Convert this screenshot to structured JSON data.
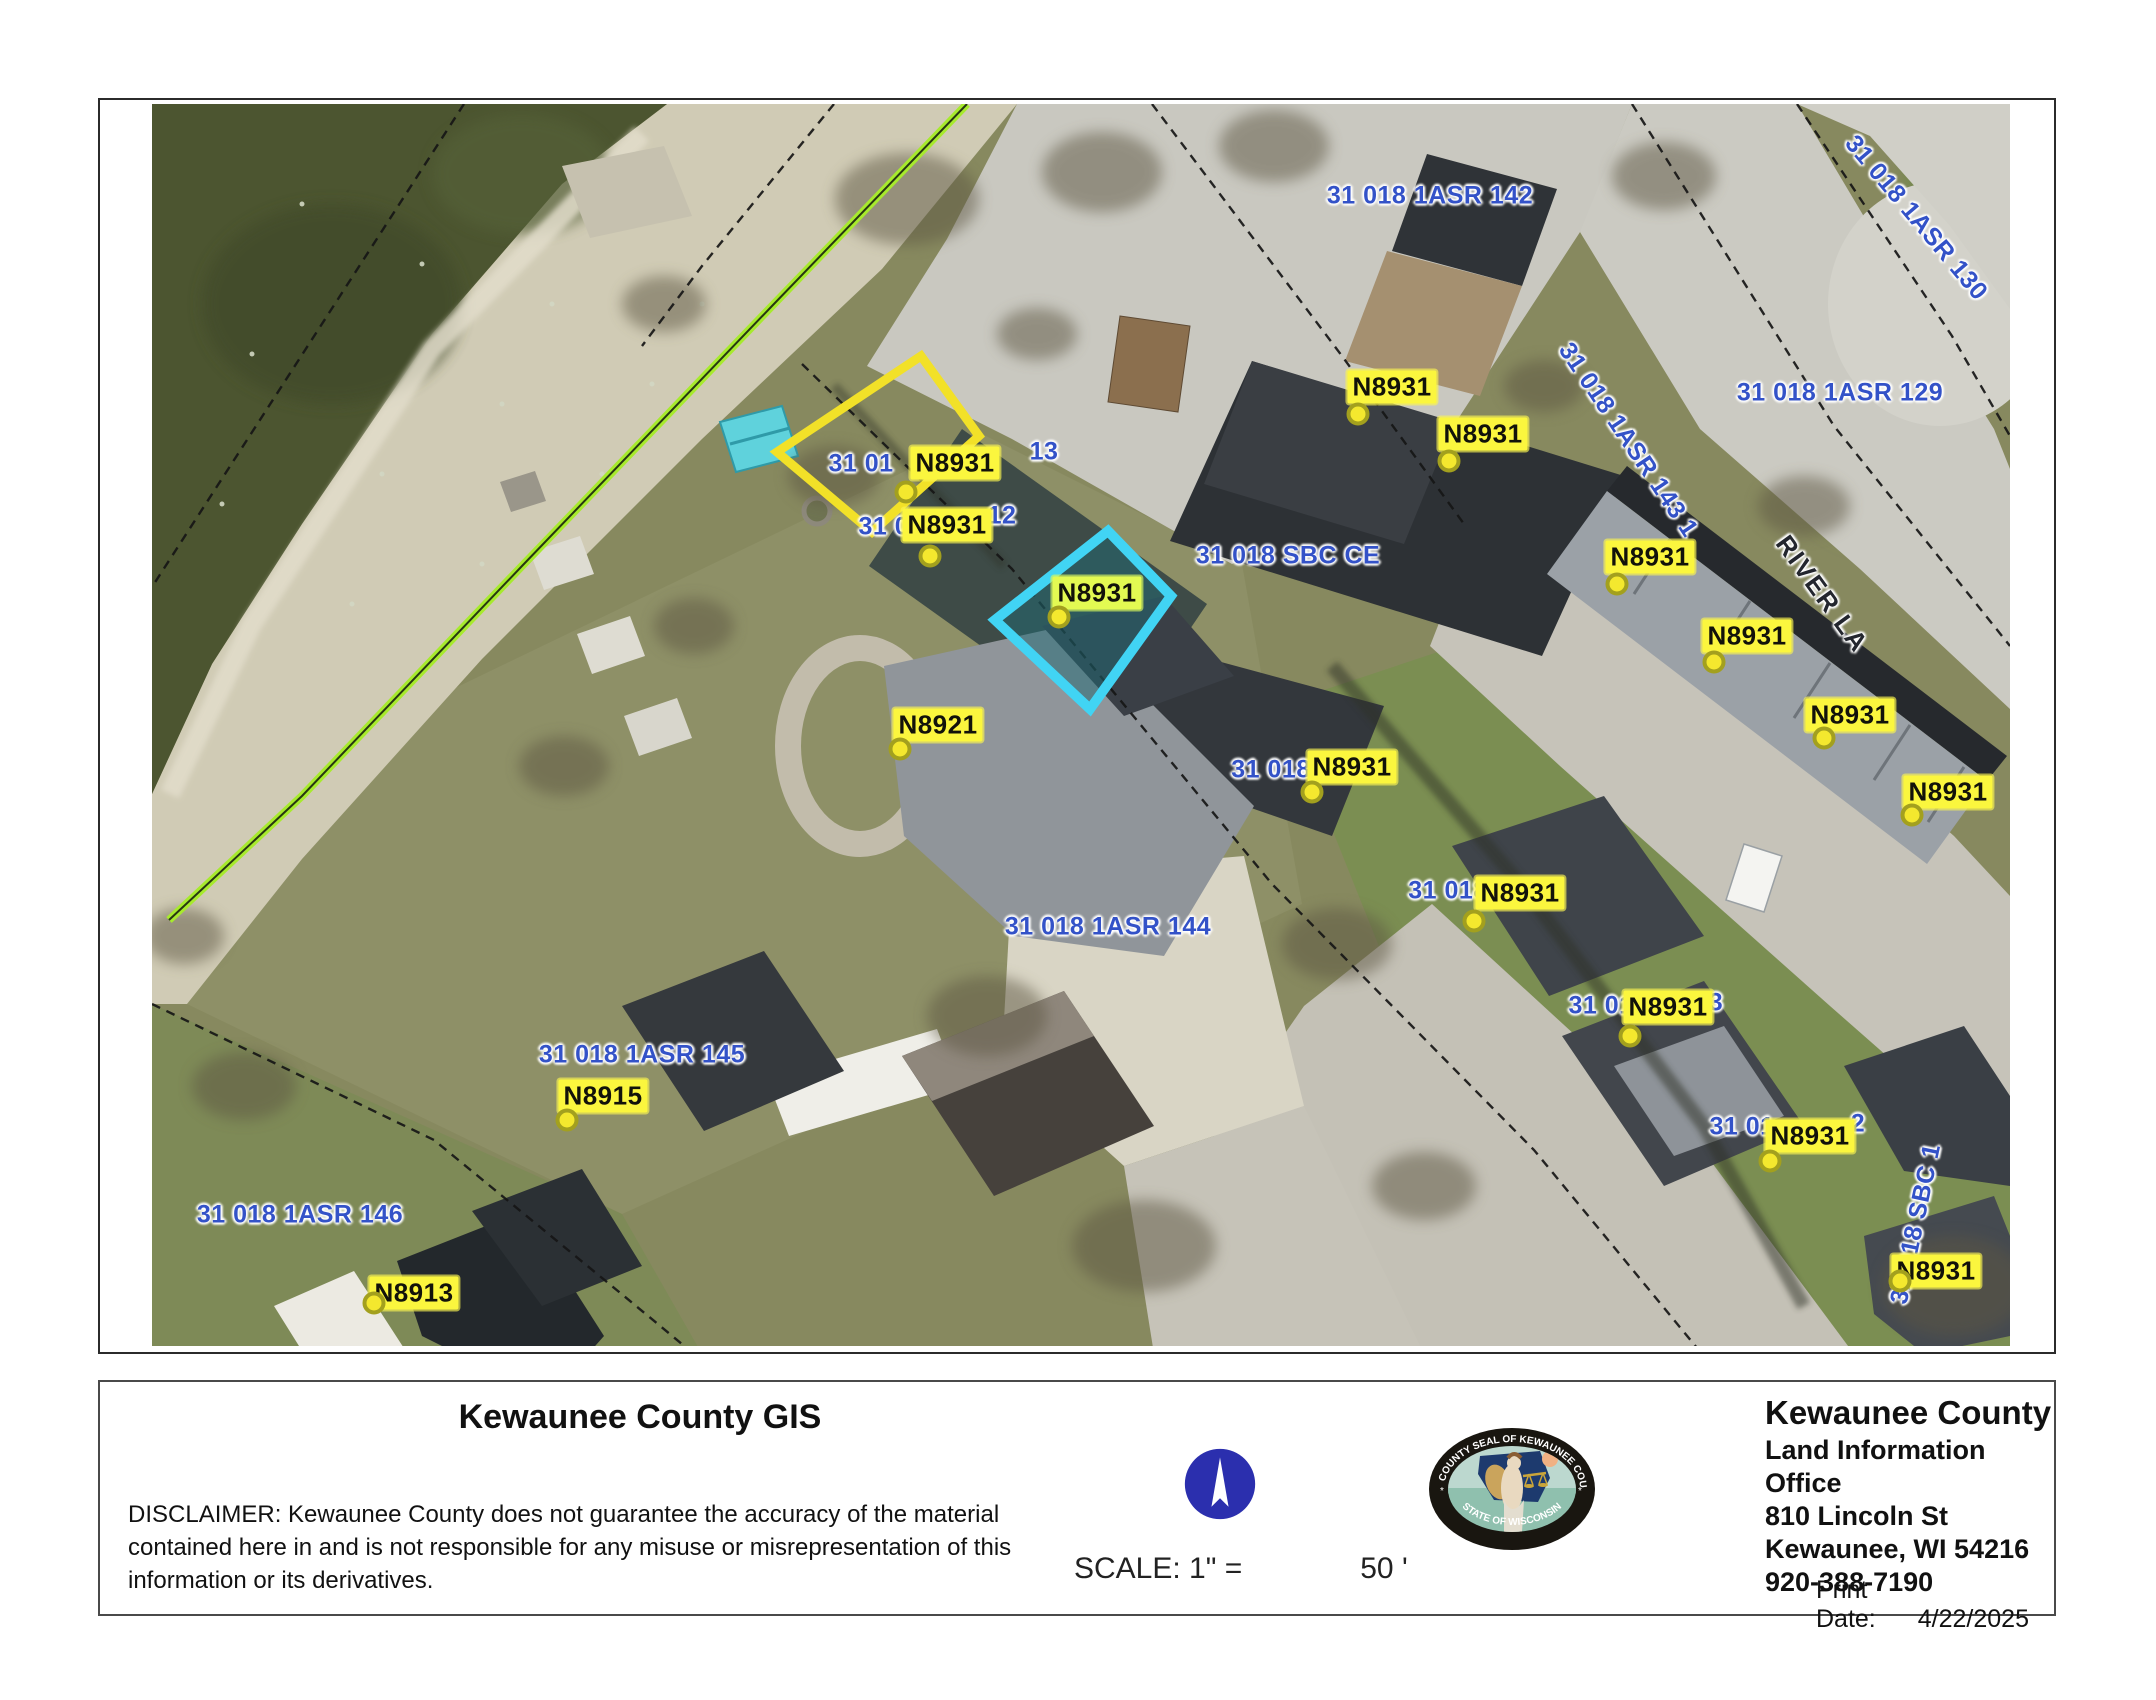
{
  "colors": {
    "label-blue": "#3352c8",
    "address-yellow": "#fbf63e",
    "address-green": "#e3fa52",
    "highlight-cyan": "#41d4f4",
    "highlight-yellow": "#f2e128",
    "shoreline-lime": "#a7ea2d",
    "compass-blue": "#2b2fae",
    "road-label": "#23262e"
  },
  "map": {
    "labels": [
      {
        "text": "31 018 1ASR 142",
        "x": 1430,
        "y": 196,
        "type": "parcel"
      },
      {
        "text": "31 018 1ASR 130",
        "x": 1916,
        "y": 218,
        "rot": 50,
        "type": "parcel"
      },
      {
        "text": "31 018 1ASR 129",
        "x": 1840,
        "y": 393,
        "type": "parcel"
      },
      {
        "text": "31 018 1ASR 143 1",
        "x": 1628,
        "y": 440,
        "rot": 56,
        "type": "parcel"
      },
      {
        "text": "31 018 SBC CE",
        "x": 1288,
        "y": 556,
        "type": "parcel"
      },
      {
        "text": "31 01",
        "x": 861,
        "y": 464,
        "type": "parcel"
      },
      {
        "text": "13",
        "x": 1044,
        "y": 452,
        "type": "parcel"
      },
      {
        "text": "31 01",
        "x": 891,
        "y": 527,
        "type": "parcel"
      },
      {
        "text": "12",
        "x": 1002,
        "y": 516,
        "type": "parcel"
      },
      {
        "text": "31 018",
        "x": 1271,
        "y": 770,
        "type": "parcel"
      },
      {
        "text": "31 018",
        "x": 1448,
        "y": 891,
        "type": "parcel"
      },
      {
        "text": "31 01",
        "x": 1601,
        "y": 1006,
        "type": "parcel"
      },
      {
        "text": "3",
        "x": 1716,
        "y": 1003,
        "type": "parcel"
      },
      {
        "text": "31 01",
        "x": 1742,
        "y": 1127,
        "type": "parcel"
      },
      {
        "text": "2",
        "x": 1858,
        "y": 1124,
        "type": "parcel"
      },
      {
        "text": "31 018 SBC 1",
        "x": 1916,
        "y": 1224,
        "rot": -78,
        "type": "parcel"
      },
      {
        "text": "31 018 1ASR 144",
        "x": 1108,
        "y": 927,
        "type": "parcel"
      },
      {
        "text": "31 018 1ASR 145",
        "x": 642,
        "y": 1055,
        "type": "parcel"
      },
      {
        "text": "31 018 1ASR 146",
        "x": 300,
        "y": 1215,
        "type": "parcel"
      },
      {
        "text": "RIVER LA",
        "x": 1822,
        "y": 594,
        "rot": 54,
        "type": "road"
      },
      {
        "text": "N8931",
        "x": 1392,
        "y": 387,
        "type": "address",
        "dot": [
          1358,
          414
        ]
      },
      {
        "text": "N8931",
        "x": 1483,
        "y": 434,
        "type": "address",
        "dot": [
          1449,
          461
        ]
      },
      {
        "text": "N8931",
        "x": 955,
        "y": 463,
        "type": "address",
        "dot": [
          906,
          492
        ]
      },
      {
        "text": "N8931",
        "x": 947,
        "y": 525,
        "type": "address",
        "dot": [
          930,
          556
        ]
      },
      {
        "text": "N8931",
        "x": 1097,
        "y": 593,
        "type": "address",
        "variant": "green",
        "dot": [
          1059,
          617
        ]
      },
      {
        "text": "N8921",
        "x": 938,
        "y": 725,
        "type": "address",
        "dot": [
          900,
          749
        ]
      },
      {
        "text": "N8931",
        "x": 1352,
        "y": 767,
        "type": "address",
        "dot": [
          1312,
          792
        ]
      },
      {
        "text": "N8931",
        "x": 1650,
        "y": 557,
        "type": "address",
        "dot": [
          1617,
          584
        ]
      },
      {
        "text": "N8931",
        "x": 1747,
        "y": 636,
        "type": "address",
        "dot": [
          1714,
          662
        ]
      },
      {
        "text": "N8931",
        "x": 1850,
        "y": 715,
        "type": "address",
        "dot": [
          1824,
          738
        ]
      },
      {
        "text": "N8931",
        "x": 1948,
        "y": 792,
        "type": "address",
        "dot": [
          1912,
          815
        ]
      },
      {
        "text": "N8931",
        "x": 1520,
        "y": 893,
        "type": "address",
        "dot": [
          1474,
          921
        ]
      },
      {
        "text": "N8931",
        "x": 1668,
        "y": 1007,
        "type": "address",
        "dot": [
          1630,
          1036
        ]
      },
      {
        "text": "N8931",
        "x": 1810,
        "y": 1136,
        "type": "address",
        "dot": [
          1770,
          1161
        ]
      },
      {
        "text": "N8931",
        "x": 1936,
        "y": 1271,
        "type": "address",
        "dot": [
          1900,
          1281
        ]
      },
      {
        "text": "N8915",
        "x": 603,
        "y": 1096,
        "type": "address",
        "dot": [
          567,
          1120
        ]
      },
      {
        "text": "N8913",
        "x": 414,
        "y": 1293,
        "type": "address",
        "dot": [
          374,
          1303
        ]
      }
    ]
  },
  "footer": {
    "title": "Kewaunee County GIS",
    "disclaimer_lines": [
      "DISCLAIMER: Kewaunee County does not guarantee the accuracy of the material",
      "contained here in and is not responsible for any misuse or misrepresentation of this",
      "information or its derivatives."
    ],
    "scale_label": "SCALE: 1\" =",
    "scale_value": "50 '",
    "seal_top": "COUNTY SEAL OF KEWAUNEE COUNTY",
    "seal_bottom": "STATE OF WISCONSIN",
    "org": {
      "name": "Kewaunee County",
      "office": "Land Information Office",
      "address1": "810 Lincoln St",
      "address2": "Kewaunee, WI 54216",
      "phone": "920-388-7190"
    },
    "print_date_label": "Print Date:",
    "print_date": "4/22/2025"
  }
}
